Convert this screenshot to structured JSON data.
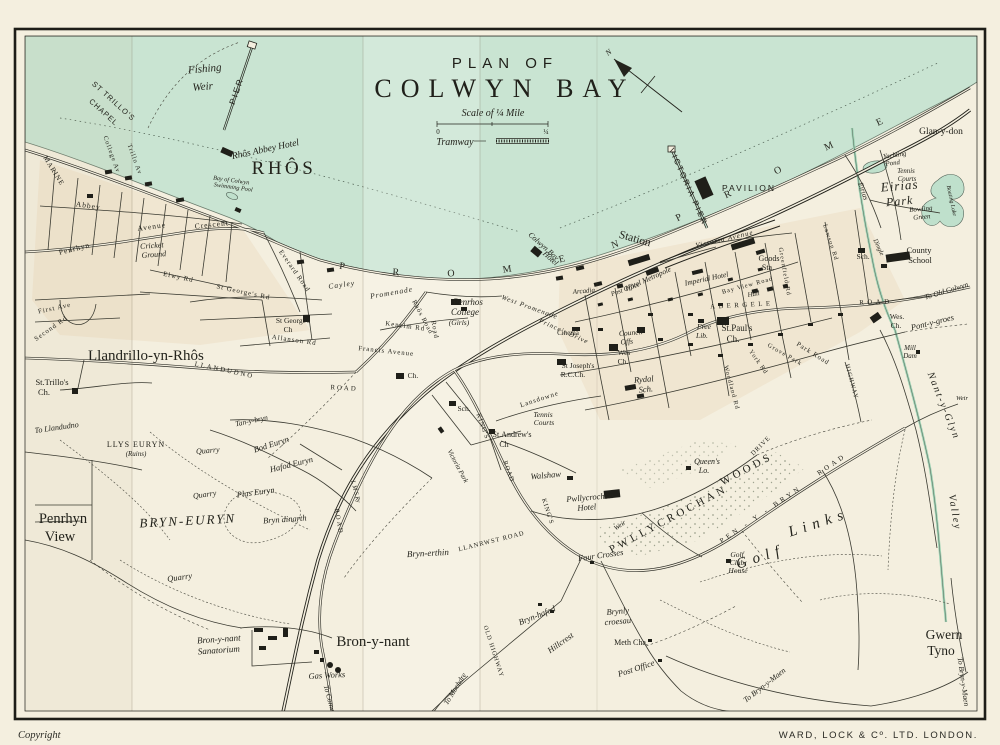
{
  "title": {
    "line1": "PLAN OF",
    "line2": "COLWYN BAY"
  },
  "legend": {
    "scale_label": "Scale of ¼ Mile",
    "scale_zero": "0",
    "scale_quarter": "¼",
    "tramway_label": "Tramway"
  },
  "compass": {
    "north_label": "N"
  },
  "margin": {
    "copyright": "Copyright",
    "publisher": "WARD, LOCK & Cº. LTD.   LONDON."
  },
  "promenade": {
    "bay_label": "P R O M E N A D E",
    "east_label": "P R O M E N A D E"
  },
  "colors": {
    "sea": "#c9e4d2",
    "paper": "#f4efdf",
    "ink": "#23231c",
    "water_green": "#bfe0cc"
  },
  "map_labels": [
    {
      "t": "Fishing",
      "x": 205,
      "y": 72,
      "s": 11,
      "r": -5,
      "c": "it"
    },
    {
      "t": "Weir",
      "x": 203,
      "y": 90,
      "s": 11,
      "r": -5,
      "c": "it"
    },
    {
      "t": "PIER",
      "x": 239,
      "y": 92,
      "s": 8.5,
      "r": -71,
      "c": "sans sp2"
    },
    {
      "t": "ST TRILLO'S",
      "x": 112,
      "y": 103,
      "s": 7.5,
      "r": 42,
      "c": "sans sp1"
    },
    {
      "t": "CHAPEL",
      "x": 102,
      "y": 114,
      "s": 7.5,
      "r": 42,
      "c": "sans sp1"
    },
    {
      "t": "Rhôs Abbey Hotel",
      "x": 266,
      "y": 152,
      "s": 9.5,
      "r": -12,
      "c": "it"
    },
    {
      "t": "RHÔS",
      "x": 284,
      "y": 174,
      "s": 19,
      "r": 0,
      "c": "sp3"
    },
    {
      "t": "Bay of Colwyn",
      "x": 231,
      "y": 182,
      "s": 6.2,
      "r": 8,
      "c": "it"
    },
    {
      "t": "Swimming Pool",
      "x": 233,
      "y": 189,
      "s": 6.2,
      "r": 8,
      "c": "it"
    },
    {
      "t": "MARINE",
      "x": 52,
      "y": 172,
      "s": 7,
      "r": 58,
      "c": "sp1"
    },
    {
      "t": "College Av",
      "x": 110,
      "y": 155,
      "s": 6.5,
      "r": 70,
      "c": "sp1"
    },
    {
      "t": "Trillo Av",
      "x": 133,
      "y": 160,
      "s": 6.5,
      "r": 70,
      "c": "sp1"
    },
    {
      "t": "Abbey",
      "x": 88,
      "y": 208,
      "s": 7.5,
      "r": 8,
      "c": "sp1"
    },
    {
      "t": "Penrhyn",
      "x": 75,
      "y": 251,
      "s": 7.5,
      "r": -14,
      "c": "sp1"
    },
    {
      "t": "Avenue",
      "x": 152,
      "y": 229,
      "s": 7.5,
      "r": -8,
      "c": "sp1"
    },
    {
      "t": "Crescent",
      "x": 212,
      "y": 227,
      "s": 7.5,
      "r": -6,
      "c": "sp1"
    },
    {
      "t": "Cricket",
      "x": 152,
      "y": 248,
      "s": 8,
      "r": -4,
      "c": "it"
    },
    {
      "t": "Ground",
      "x": 154,
      "y": 257,
      "s": 8,
      "r": -4,
      "c": "it"
    },
    {
      "t": "Everard Road",
      "x": 293,
      "y": 272,
      "s": 6.8,
      "r": 55,
      "c": "sp1"
    },
    {
      "t": "St George's Rd",
      "x": 243,
      "y": 294,
      "s": 6.8,
      "r": 12,
      "c": "sp1"
    },
    {
      "t": "St George's",
      "x": 293,
      "y": 323,
      "s": 7.5,
      "r": 0,
      "c": ""
    },
    {
      "t": "Ch",
      "x": 288,
      "y": 332,
      "s": 7.5,
      "r": 0,
      "c": ""
    },
    {
      "t": "Allanson Rd",
      "x": 294,
      "y": 342,
      "s": 6.8,
      "r": 8,
      "c": "sp1"
    },
    {
      "t": "Elwy Rd",
      "x": 178,
      "y": 279,
      "s": 6.8,
      "r": 12,
      "c": "sp1"
    },
    {
      "t": "First Ave",
      "x": 55,
      "y": 310,
      "s": 6.8,
      "r": -12,
      "c": "sp1"
    },
    {
      "t": "Second Rd",
      "x": 52,
      "y": 330,
      "s": 6.8,
      "r": -35,
      "c": "sp1"
    },
    {
      "t": "To Llandudno",
      "x": 57,
      "y": 430,
      "s": 8,
      "r": -8,
      "c": "it"
    },
    {
      "t": "Llandrillo-yn-Rhôs",
      "x": 88,
      "y": 360,
      "s": 15,
      "r": 0,
      "c": "",
      "a": "start"
    },
    {
      "t": "St.Trillo's",
      "x": 52,
      "y": 385,
      "s": 8.5,
      "r": 0,
      "c": ""
    },
    {
      "t": "Ch.",
      "x": 44,
      "y": 395,
      "s": 8.5,
      "r": 0,
      "c": ""
    },
    {
      "t": "LLYS EURYN",
      "x": 136,
      "y": 447,
      "s": 8,
      "r": 0,
      "c": "sp1"
    },
    {
      "t": "(Ruins)",
      "x": 136,
      "y": 456,
      "s": 7,
      "r": 0,
      "c": "it"
    },
    {
      "t": "Penrhyn",
      "x": 63,
      "y": 523,
      "s": 14.5,
      "r": 0,
      "c": ""
    },
    {
      "t": "View",
      "x": 60,
      "y": 541,
      "s": 14.5,
      "r": 0,
      "c": ""
    },
    {
      "t": "LLANDUDNO",
      "x": 224,
      "y": 372,
      "s": 6.8,
      "r": 12,
      "c": "sp2"
    },
    {
      "t": "ROAD",
      "x": 344,
      "y": 390,
      "s": 6.8,
      "r": 3,
      "c": "sp2"
    },
    {
      "t": "Quarry",
      "x": 208,
      "y": 453,
      "s": 8,
      "r": -5,
      "c": "it"
    },
    {
      "t": "Quarry",
      "x": 205,
      "y": 497,
      "s": 8,
      "r": -8,
      "c": "it"
    },
    {
      "t": "Quarry",
      "x": 180,
      "y": 580,
      "s": 8.5,
      "r": -8,
      "c": "it"
    },
    {
      "t": "Bod Euryn",
      "x": 272,
      "y": 447,
      "s": 8.5,
      "r": -18,
      "c": "it"
    },
    {
      "t": "Hafod Euryn",
      "x": 292,
      "y": 467,
      "s": 8.5,
      "r": -14,
      "c": "it"
    },
    {
      "t": "Plas Euryn",
      "x": 256,
      "y": 495,
      "s": 8.5,
      "r": -8,
      "c": "it"
    },
    {
      "t": "BRYN-EURYN",
      "x": 188,
      "y": 525,
      "s": 13,
      "r": -3,
      "c": "it sp2"
    },
    {
      "t": "Bryn dinarth",
      "x": 285,
      "y": 522,
      "s": 8.5,
      "r": -4,
      "c": "it"
    },
    {
      "t": "Tan-y-bryn",
      "x": 252,
      "y": 423,
      "s": 7.5,
      "r": -12,
      "c": "it"
    },
    {
      "t": "Bron-y-nant",
      "x": 219,
      "y": 642,
      "s": 9,
      "r": -4,
      "c": "it"
    },
    {
      "t": "Sanatorium",
      "x": 219,
      "y": 653,
      "s": 9,
      "r": -4,
      "c": "it"
    },
    {
      "t": "Bron-y-nant",
      "x": 373,
      "y": 646,
      "s": 15,
      "r": 0,
      "c": ""
    },
    {
      "t": "Gas Works",
      "x": 327,
      "y": 678,
      "s": 8.5,
      "r": -3,
      "c": "it"
    },
    {
      "t": "To Conway",
      "x": 328,
      "y": 702,
      "s": 7.5,
      "r": 75,
      "c": "it"
    },
    {
      "t": "To Mochdre",
      "x": 457,
      "y": 690,
      "s": 7.5,
      "r": -58,
      "c": "it"
    },
    {
      "t": "Bryn-erthin",
      "x": 428,
      "y": 556,
      "s": 9,
      "r": -3,
      "c": "it"
    },
    {
      "t": "L M S Ry",
      "x": 354,
      "y": 492,
      "s": 6.2,
      "r": 75,
      "c": "it"
    },
    {
      "t": "ROAD",
      "x": 337,
      "y": 522,
      "s": 6.5,
      "r": 80,
      "c": "sp2"
    },
    {
      "t": "LLANRWST ROAD",
      "x": 492,
      "y": 543,
      "s": 6.5,
      "r": -14,
      "c": "sp1"
    },
    {
      "t": "Four Crosses",
      "x": 601,
      "y": 558,
      "s": 8.5,
      "r": -8,
      "c": "it"
    },
    {
      "t": "Bryn-hafod",
      "x": 538,
      "y": 618,
      "s": 8.5,
      "r": -22,
      "c": "it"
    },
    {
      "t": "Brynly",
      "x": 618,
      "y": 614,
      "s": 8.5,
      "r": -5,
      "c": "it"
    },
    {
      "t": "croesau",
      "x": 618,
      "y": 624,
      "s": 8.5,
      "r": -5,
      "c": "it"
    },
    {
      "t": "Hillcrest",
      "x": 562,
      "y": 645,
      "s": 8.5,
      "r": -35,
      "c": "it"
    },
    {
      "t": "Meth Cha.",
      "x": 631,
      "y": 645,
      "s": 8,
      "r": 0,
      "c": ""
    },
    {
      "t": "Post Office",
      "x": 637,
      "y": 671,
      "s": 8.5,
      "r": -18,
      "c": "it"
    },
    {
      "t": "OLD HIGHWAY",
      "x": 492,
      "y": 652,
      "s": 6.2,
      "r": 72,
      "c": "sp1"
    },
    {
      "t": "To Bryn-y-Maen",
      "x": 766,
      "y": 687,
      "s": 7.8,
      "r": -38,
      "c": "it"
    },
    {
      "t": "To Bryn-y-Maen",
      "x": 961,
      "y": 682,
      "s": 7.5,
      "r": 82,
      "c": "it"
    },
    {
      "t": "Gwern",
      "x": 944,
      "y": 639,
      "s": 13.5,
      "r": 0,
      "c": ""
    },
    {
      "t": "Tyno",
      "x": 941,
      "y": 655,
      "s": 13.5,
      "r": 0,
      "c": ""
    },
    {
      "t": "Golf",
      "x": 762,
      "y": 561,
      "s": 15,
      "r": -18,
      "c": "it sp6"
    },
    {
      "t": "Links",
      "x": 820,
      "y": 527,
      "s": 15,
      "r": -18,
      "c": "it sp6"
    },
    {
      "t": "Golf",
      "x": 737,
      "y": 557,
      "s": 7.5,
      "r": 0,
      "c": "it"
    },
    {
      "t": "Club",
      "x": 737,
      "y": 565,
      "s": 7.5,
      "r": 0,
      "c": "it"
    },
    {
      "t": "House",
      "x": 738,
      "y": 573,
      "s": 7.5,
      "r": 0,
      "c": "it"
    },
    {
      "t": "PWLLYCROCHAN",
      "x": 670,
      "y": 522,
      "s": 11,
      "r": -28,
      "c": "sp3"
    },
    {
      "t": "WOODS",
      "x": 748,
      "y": 472,
      "s": 11,
      "r": -28,
      "c": "sp3"
    },
    {
      "t": "Pwllycrochan",
      "x": 590,
      "y": 500,
      "s": 8.5,
      "r": -5,
      "c": "it"
    },
    {
      "t": "Hotel",
      "x": 587,
      "y": 510,
      "s": 8.5,
      "r": -5,
      "c": "it"
    },
    {
      "t": "Queen's",
      "x": 707,
      "y": 464,
      "s": 8,
      "r": 0,
      "c": "it"
    },
    {
      "t": "Lo.",
      "x": 704,
      "y": 473,
      "s": 8,
      "r": 0,
      "c": "it"
    },
    {
      "t": "Weir",
      "x": 621,
      "y": 527,
      "s": 6.8,
      "r": -35,
      "c": "it"
    },
    {
      "t": "KING'S",
      "x": 481,
      "y": 427,
      "s": 6.5,
      "r": 70,
      "c": "sp1"
    },
    {
      "t": "ROAD",
      "x": 507,
      "y": 472,
      "s": 6.5,
      "r": 70,
      "c": "sp1"
    },
    {
      "t": "KING'S",
      "x": 546,
      "y": 512,
      "s": 6.5,
      "r": 72,
      "c": "sp1"
    },
    {
      "t": "DRIVE",
      "x": 762,
      "y": 447,
      "s": 6.5,
      "r": -45,
      "c": "sp1"
    },
    {
      "t": "Victoria Park",
      "x": 456,
      "y": 467,
      "s": 6.8,
      "r": 62,
      "c": "it"
    },
    {
      "t": "Walshaw",
      "x": 546,
      "y": 478,
      "s": 8.5,
      "r": -5,
      "c": "it"
    },
    {
      "t": "St.Andrew's",
      "x": 512,
      "y": 437,
      "s": 8,
      "r": 0,
      "c": ""
    },
    {
      "t": "Ch",
      "x": 504,
      "y": 447,
      "s": 8,
      "r": 0,
      "c": ""
    },
    {
      "t": "Tennis",
      "x": 543,
      "y": 417,
      "s": 7.5,
      "r": 0,
      "c": "it"
    },
    {
      "t": "Courts",
      "x": 544,
      "y": 425,
      "s": 7.5,
      "r": 0,
      "c": "it"
    },
    {
      "t": "Sch.",
      "x": 464,
      "y": 411,
      "s": 7.5,
      "r": 0,
      "c": ""
    },
    {
      "t": "Lansdowne",
      "x": 540,
      "y": 401,
      "s": 6.8,
      "r": -18,
      "c": "sp1"
    },
    {
      "t": "Road",
      "x": 433,
      "y": 330,
      "s": 6.8,
      "r": 80,
      "c": "sp1"
    },
    {
      "t": "Cayley",
      "x": 342,
      "y": 287,
      "s": 7.5,
      "r": -8,
      "c": "it sp1"
    },
    {
      "t": "Promenade",
      "x": 392,
      "y": 295,
      "s": 7.5,
      "r": -10,
      "c": "it sp1"
    },
    {
      "t": "West Promenade",
      "x": 529,
      "y": 309,
      "s": 6.8,
      "r": 20,
      "c": "it sp1"
    },
    {
      "t": "Prince's Drive",
      "x": 563,
      "y": 333,
      "s": 6.8,
      "r": 24,
      "c": "it sp1"
    },
    {
      "t": "Penrhos",
      "x": 468,
      "y": 305,
      "s": 9,
      "r": 0,
      "c": "it"
    },
    {
      "t": "College",
      "x": 465,
      "y": 315,
      "s": 9,
      "r": 0,
      "c": "it"
    },
    {
      "t": "(Girls)",
      "x": 459,
      "y": 325,
      "s": 7.5,
      "r": 0,
      "c": "it"
    },
    {
      "t": "Kenelm Rd",
      "x": 405,
      "y": 328,
      "s": 6.8,
      "r": 8,
      "c": "sp1"
    },
    {
      "t": "Francis Avenue",
      "x": 386,
      "y": 353,
      "s": 6.8,
      "r": 6,
      "c": "sp1"
    },
    {
      "t": "Ch.",
      "x": 413,
      "y": 378,
      "s": 7.5,
      "r": 0,
      "c": ""
    },
    {
      "t": "Station",
      "x": 634,
      "y": 242,
      "s": 11.5,
      "r": 16,
      "c": ""
    },
    {
      "t": "Colwyn Bay",
      "x": 542,
      "y": 248,
      "s": 7.8,
      "r": 42,
      "c": "it"
    },
    {
      "t": "Hotel",
      "x": 549,
      "y": 260,
      "s": 7.8,
      "r": 42,
      "c": "it"
    },
    {
      "t": "VICTORIA PIER",
      "x": 686,
      "y": 188,
      "s": 8,
      "r": 66,
      "c": "sans sp2"
    },
    {
      "t": "PAVILION",
      "x": 749,
      "y": 191,
      "s": 8.5,
      "r": 0,
      "c": "sans sp2"
    },
    {
      "t": "Victoria Avenue",
      "x": 725,
      "y": 241,
      "s": 7,
      "r": -13,
      "c": "it sp1"
    },
    {
      "t": "Hotel Metropole",
      "x": 649,
      "y": 281,
      "s": 7.5,
      "r": -24,
      "c": "it"
    },
    {
      "t": "Post Office",
      "x": 626,
      "y": 291,
      "s": 6.8,
      "r": -20,
      "c": "it"
    },
    {
      "t": "Imperial Hotel",
      "x": 707,
      "y": 281,
      "s": 7.5,
      "r": -12,
      "c": "it"
    },
    {
      "t": "Arcadia",
      "x": 584,
      "y": 293,
      "s": 7,
      "r": -5,
      "c": "it"
    },
    {
      "t": "Goods",
      "x": 769,
      "y": 261,
      "s": 8,
      "r": 0,
      "c": ""
    },
    {
      "t": "Sta.",
      "x": 768,
      "y": 270,
      "s": 8,
      "r": 0,
      "c": ""
    },
    {
      "t": "Bay View Road",
      "x": 748,
      "y": 287,
      "s": 6.3,
      "r": -15,
      "c": "sp1"
    },
    {
      "t": "Hall",
      "x": 754,
      "y": 296,
      "s": 6.8,
      "r": -10,
      "c": "it"
    },
    {
      "t": "St.Paul's",
      "x": 737,
      "y": 331,
      "s": 9,
      "r": 0,
      "c": ""
    },
    {
      "t": "Ch.",
      "x": 733,
      "y": 342,
      "s": 9,
      "r": 0,
      "c": ""
    },
    {
      "t": "Free",
      "x": 704,
      "y": 329,
      "s": 7.5,
      "r": 0,
      "c": "it"
    },
    {
      "t": "Lib.",
      "x": 702,
      "y": 338,
      "s": 7.5,
      "r": 0,
      "c": "it"
    },
    {
      "t": "Council",
      "x": 631,
      "y": 335,
      "s": 7.5,
      "r": -5,
      "c": "it"
    },
    {
      "t": "Offs",
      "x": 627,
      "y": 344,
      "s": 7.5,
      "r": -5,
      "c": "it"
    },
    {
      "t": "Wes",
      "x": 624,
      "y": 355,
      "s": 7.5,
      "r": 0,
      "c": ""
    },
    {
      "t": "Ch.",
      "x": 623,
      "y": 364,
      "s": 7.5,
      "r": 0,
      "c": ""
    },
    {
      "t": "Cinema",
      "x": 568,
      "y": 335,
      "s": 7,
      "r": 0,
      "c": ""
    },
    {
      "t": "St Joseph's",
      "x": 578,
      "y": 368,
      "s": 7.5,
      "r": 0,
      "c": ""
    },
    {
      "t": "R.C.Ch.",
      "x": 573,
      "y": 377,
      "s": 7.5,
      "r": 0,
      "c": ""
    },
    {
      "t": "Rydal",
      "x": 644,
      "y": 382,
      "s": 8.5,
      "r": -5,
      "c": "it"
    },
    {
      "t": "Sch.",
      "x": 646,
      "y": 392,
      "s": 8.5,
      "r": -5,
      "c": "it"
    },
    {
      "t": "ABERGELE",
      "x": 742,
      "y": 307,
      "s": 6.8,
      "r": -3,
      "c": "sp3"
    },
    {
      "t": "ROAD",
      "x": 876,
      "y": 304,
      "s": 6.8,
      "r": -2,
      "c": "sp3"
    },
    {
      "t": "Greenfield Rd",
      "x": 783,
      "y": 272,
      "s": 6.3,
      "r": 80,
      "c": "sp1"
    },
    {
      "t": "Park Road",
      "x": 812,
      "y": 355,
      "s": 6.8,
      "r": 32,
      "c": "sp1"
    },
    {
      "t": "Grove Park",
      "x": 784,
      "y": 356,
      "s": 6.3,
      "r": 30,
      "c": "sp1"
    },
    {
      "t": "York Rd",
      "x": 757,
      "y": 363,
      "s": 6.3,
      "r": 55,
      "c": "sp1"
    },
    {
      "t": "Woodland Rd",
      "x": 730,
      "y": 388,
      "s": 6.3,
      "r": 75,
      "c": "sp1"
    },
    {
      "t": "County",
      "x": 919,
      "y": 253,
      "s": 8.5,
      "r": 0,
      "c": ""
    },
    {
      "t": "School",
      "x": 920,
      "y": 263,
      "s": 8.5,
      "r": 0,
      "c": ""
    },
    {
      "t": "Sch.",
      "x": 863,
      "y": 259,
      "s": 7.5,
      "r": 0,
      "c": ""
    },
    {
      "t": "To Old Colwyn",
      "x": 947,
      "y": 293,
      "s": 7.5,
      "r": -17,
      "c": "it"
    },
    {
      "t": "Pont-y-groes",
      "x": 933,
      "y": 325,
      "s": 8.5,
      "r": -14,
      "c": "it"
    },
    {
      "t": "Wes.",
      "x": 897,
      "y": 319,
      "s": 7.5,
      "r": 0,
      "c": ""
    },
    {
      "t": "Ch.",
      "x": 896,
      "y": 328,
      "s": 7.5,
      "r": 0,
      "c": ""
    },
    {
      "t": "Mill",
      "x": 910,
      "y": 350,
      "s": 7,
      "r": 0,
      "c": "it"
    },
    {
      "t": "Dam",
      "x": 910,
      "y": 358,
      "s": 7,
      "r": 0,
      "c": "it"
    },
    {
      "t": "Nant-y-Glyn",
      "x": 941,
      "y": 407,
      "s": 10,
      "r": 68,
      "c": "it sp2"
    },
    {
      "t": "Valley",
      "x": 952,
      "y": 513,
      "s": 10,
      "r": 80,
      "c": "it sp2"
    },
    {
      "t": "Weir",
      "x": 962,
      "y": 400,
      "s": 6.5,
      "r": 0,
      "c": "it"
    },
    {
      "t": "Glan-y-don",
      "x": 941,
      "y": 134,
      "s": 9.5,
      "r": 0,
      "c": ""
    },
    {
      "t": "Yachting",
      "x": 895,
      "y": 157,
      "s": 6.8,
      "r": -8,
      "c": "it"
    },
    {
      "t": "Pond",
      "x": 893,
      "y": 165,
      "s": 6.8,
      "r": -8,
      "c": "it"
    },
    {
      "t": "Tennis",
      "x": 906,
      "y": 173,
      "s": 6.8,
      "r": 0,
      "c": "it"
    },
    {
      "t": "Courts",
      "x": 907,
      "y": 181,
      "s": 6.8,
      "r": 0,
      "c": "it"
    },
    {
      "t": "Eirias",
      "x": 900,
      "y": 190,
      "s": 13,
      "r": -5,
      "c": "it sp1"
    },
    {
      "t": "Park",
      "x": 900,
      "y": 205,
      "s": 12,
      "r": -5,
      "c": "it sp1"
    },
    {
      "t": "Bowling",
      "x": 921,
      "y": 211,
      "s": 7,
      "r": -5,
      "c": "it"
    },
    {
      "t": "Green",
      "x": 922,
      "y": 219,
      "s": 7,
      "r": -5,
      "c": "it"
    },
    {
      "t": "Boating Lake",
      "x": 950,
      "y": 201,
      "s": 5.8,
      "r": 78,
      "c": "it"
    },
    {
      "t": "Eirias",
      "x": 861,
      "y": 192,
      "s": 7.5,
      "r": 70,
      "c": "it"
    },
    {
      "t": "Lawson Rd",
      "x": 829,
      "y": 243,
      "s": 6.3,
      "r": 72,
      "c": "sp1"
    },
    {
      "t": "Dingle",
      "x": 877,
      "y": 248,
      "s": 6.5,
      "r": 65,
      "c": "it"
    },
    {
      "t": "HIGHWAY",
      "x": 850,
      "y": 382,
      "s": 6.2,
      "r": 75,
      "c": "sp1"
    },
    {
      "t": "PEN - Y - BRYN",
      "x": 762,
      "y": 516,
      "s": 7,
      "r": -34,
      "c": "sp3"
    },
    {
      "t": "ROAD",
      "x": 833,
      "y": 466,
      "s": 7,
      "r": -34,
      "c": "sp3"
    },
    {
      "t": "Rhôs Road",
      "x": 421,
      "y": 318,
      "s": 6.5,
      "r": 62,
      "c": "sp1"
    }
  ]
}
